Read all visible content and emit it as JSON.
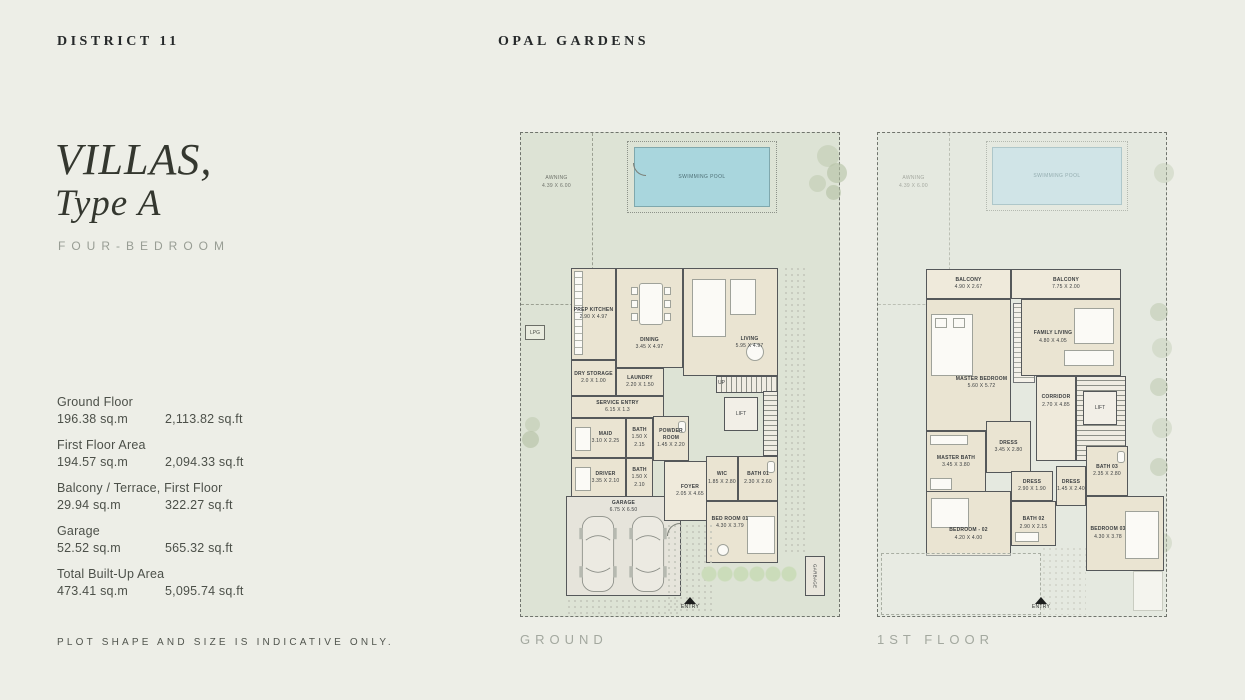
{
  "header": {
    "brand": "DISTRICT 11",
    "project": "OPAL GARDENS"
  },
  "left_panel": {
    "title_line1": "VILLAS,",
    "title_line2": "Type A",
    "subtitle": "FOUR-BEDROOM",
    "areas": [
      {
        "label": "Ground Floor",
        "sqm": "196.38 sq.m",
        "sqft": "2,113.82 sq.ft"
      },
      {
        "label": "First Floor Area",
        "sqm": "194.57 sq.m",
        "sqft": "2,094.33 sq.ft"
      },
      {
        "label": "Balcony / Terrace, First Floor",
        "sqm": "29.94 sq.m",
        "sqft": "322.27 sq.ft"
      },
      {
        "label": "Garage",
        "sqm": "52.52 sq.m",
        "sqft": "565.32 sq.ft"
      },
      {
        "label": "Total Built-Up Area",
        "sqm": "473.41 sq.m",
        "sqft": "5,095.74 sq.ft"
      }
    ],
    "note": "PLOT SHAPE AND SIZE IS INDICATIVE ONLY."
  },
  "ground_plan": {
    "caption": "GROUND",
    "pool_label": "SWIMMING POOL",
    "awning_name": "AWNING",
    "awning_dim": "4.39 X 6.00",
    "lpg_label": "LPG",
    "garbage_label": "GARBAGE",
    "entry_label": "ENTRY",
    "up_label": "UP",
    "lift_label": "LIFT",
    "rooms": [
      {
        "name": "PREP KITCHEN",
        "dim": "2.90 X 4.97"
      },
      {
        "name": "DINING",
        "dim": "3.45 X 4.97"
      },
      {
        "name": "LIVING",
        "dim": "5.95 X 4.97"
      },
      {
        "name": "DRY STORAGE",
        "dim": "2.0 X 1.00"
      },
      {
        "name": "LAUNDRY",
        "dim": "2.20 X 1.50"
      },
      {
        "name": "SERVICE ENTRY",
        "dim": "6.15 X 1.3"
      },
      {
        "name": "MAID",
        "dim": "3.10 X 2.25"
      },
      {
        "name": "BATH",
        "dim": "1.50 X 2.15"
      },
      {
        "name": "POWDER ROOM",
        "dim": "1.45 X 2.20"
      },
      {
        "name": "DRIVER",
        "dim": "3.35 X 2.10"
      },
      {
        "name": "BATH",
        "dim": "1.50 X 2.10"
      },
      {
        "name": "GARAGE",
        "dim": "6.75 X 6.50"
      },
      {
        "name": "FOYER",
        "dim": "2.05 X 4.65"
      },
      {
        "name": "WIC",
        "dim": "1.85 X 2.80"
      },
      {
        "name": "BATH 01",
        "dim": "2.30 X 2.60"
      },
      {
        "name": "BED ROOM 01",
        "dim": "4.30 X 3.79"
      }
    ]
  },
  "first_plan": {
    "caption": "1ST FLOOR",
    "pool_label": "SWIMMING POOL",
    "awning_name": "AWNING",
    "awning_dim": "4.39 X 6.00",
    "entry_label": "ENTRY",
    "lift_label": "LIFT",
    "rooms": [
      {
        "name": "BALCONY",
        "dim": "4.90 X 2.67"
      },
      {
        "name": "BALCONY",
        "dim": "7.75 X 2.00"
      },
      {
        "name": "MASTER BEDROOM",
        "dim": "5.60 X 5.72"
      },
      {
        "name": "FAMILY LIVING",
        "dim": "4.80 X 4.05"
      },
      {
        "name": "MASTER BATH",
        "dim": "3.45 X 3.80"
      },
      {
        "name": "DRESS",
        "dim": "3.45 X 2.80"
      },
      {
        "name": "CORRIDOR",
        "dim": "2.70 X 4.85"
      },
      {
        "name": "BEDROOM - 02",
        "dim": "4.20 X 4.00"
      },
      {
        "name": "DRESS",
        "dim": "2.90 X 1.90"
      },
      {
        "name": "BATH 02",
        "dim": "2.90 X 2.15"
      },
      {
        "name": "DRESS",
        "dim": "1.45 X 2.40"
      },
      {
        "name": "BATH 03",
        "dim": "2.35 X 2.80"
      },
      {
        "name": "BEDROOM 03",
        "dim": "4.30 X 3.78"
      }
    ]
  },
  "colors": {
    "page_bg": "#edeee7",
    "lawn": "#dde3d5",
    "lawn_faded": "#e5e9e0",
    "pool": "#a9d6dd",
    "pool_faded": "#d0e4e7",
    "building": "#eae4d2",
    "wall": "#55585a"
  }
}
